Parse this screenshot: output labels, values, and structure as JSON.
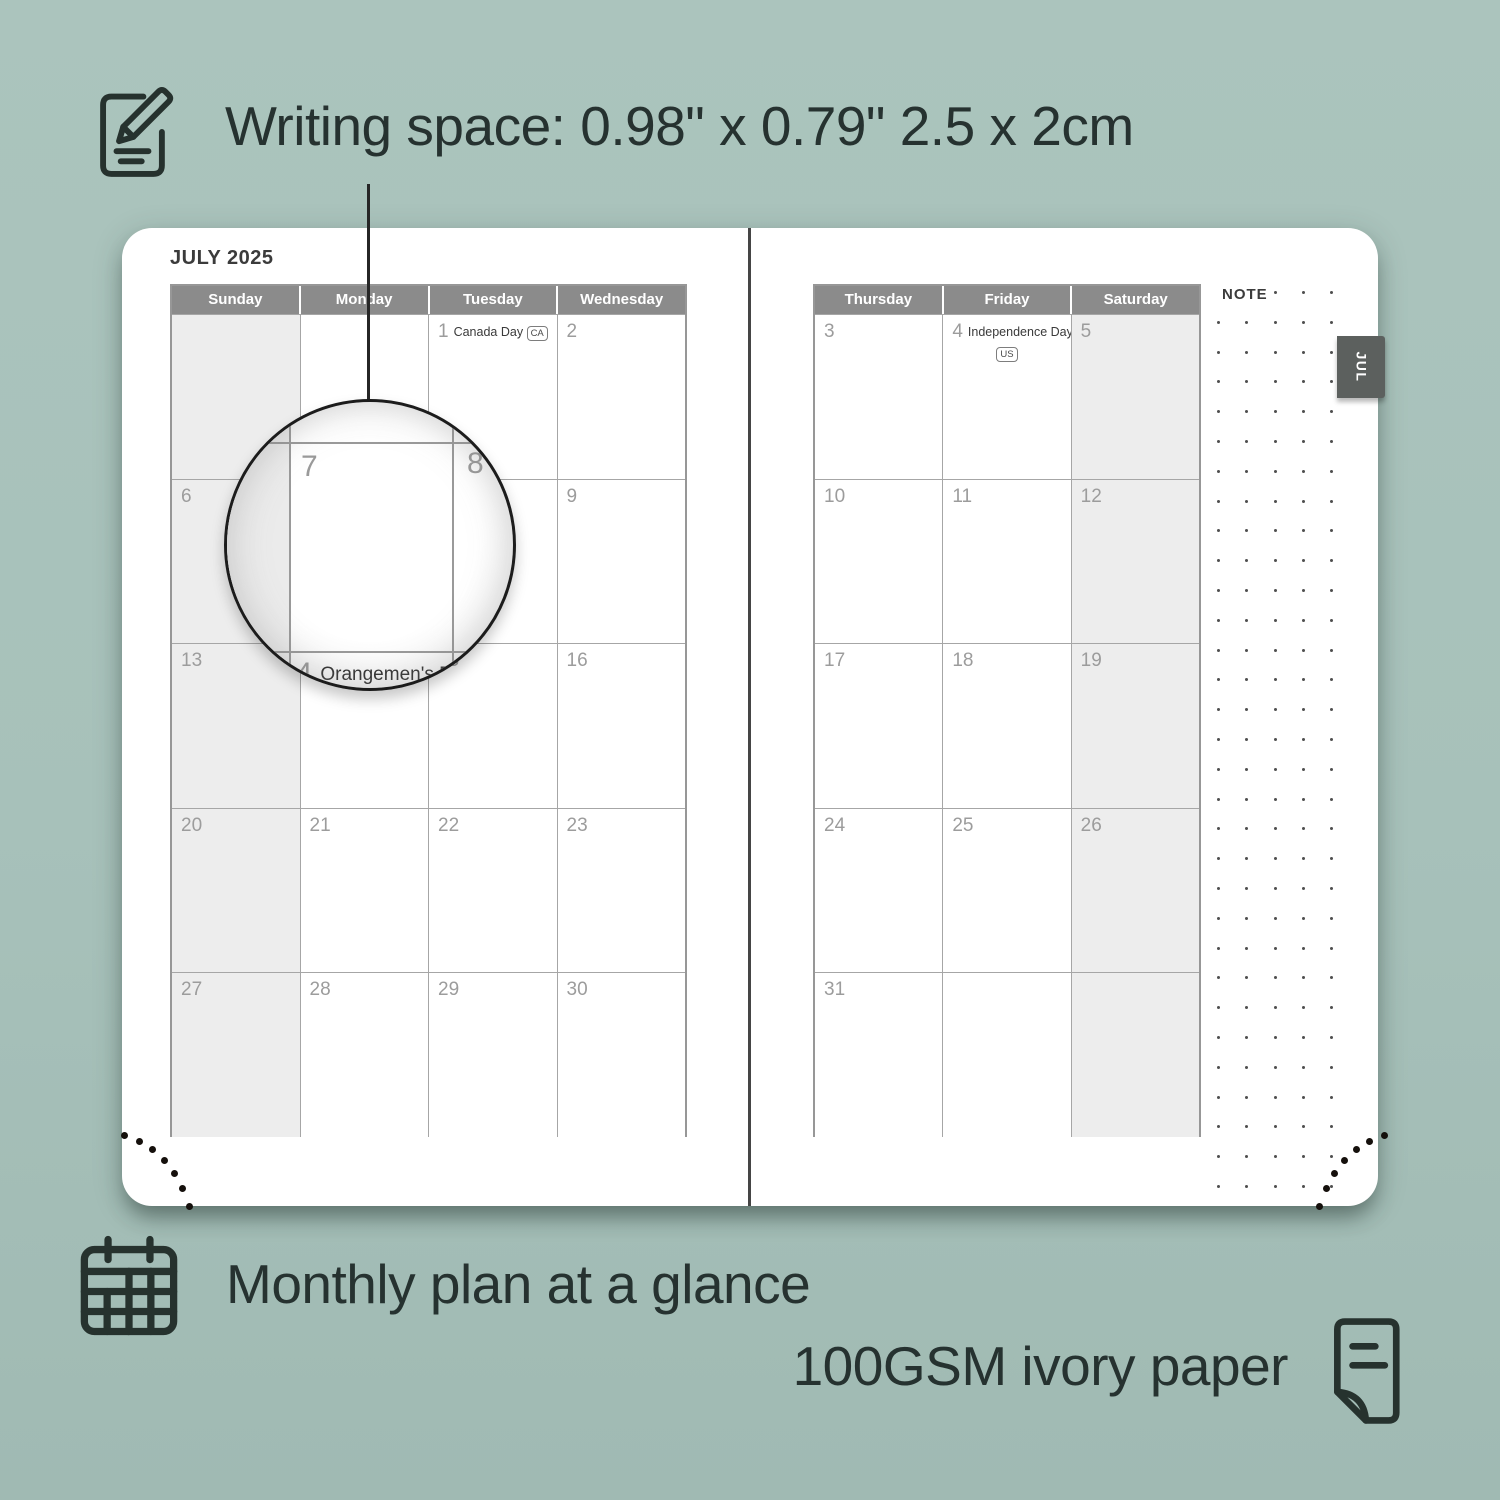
{
  "colors": {
    "background": "#a7c1ba",
    "card": "#ffffff",
    "header_gray": "#8b8b8b",
    "weekend_shade": "#ededed",
    "grid_line": "#a6a6a6",
    "day_number": "#9c9c9c",
    "dark_text": "#263230",
    "tab_gray": "#5c605e",
    "spine": "#454545"
  },
  "icons": {
    "top_left": "notepad-pencil-icon",
    "bottom_left": "calendar-grid-icon",
    "bottom_right": "paper-sheet-icon"
  },
  "captions": {
    "writing_space": "Writing space: 0.98\" x 0.79\" 2.5 x 2cm",
    "monthly": "Monthly plan at a glance",
    "paper": "100GSM ivory paper"
  },
  "planner": {
    "title": "JULY 2025",
    "note_label": "NOTE",
    "tab_label": "JUL",
    "left_headers": [
      "Sunday",
      "Monday",
      "Tuesday",
      "Wednesday"
    ],
    "right_headers": [
      "Thursday",
      "Friday",
      "Saturday"
    ],
    "left_weeks": [
      [
        {
          "day": ""
        },
        {
          "day": ""
        },
        {
          "day": "1",
          "holiday": "Canada Day",
          "badge": "CA",
          "badge_inline": true
        },
        {
          "day": "2"
        }
      ],
      [
        {
          "day": "6"
        },
        {
          "day": "7"
        },
        {
          "day": "8"
        },
        {
          "day": "9"
        }
      ],
      [
        {
          "day": "13"
        },
        {
          "day": "14",
          "holiday": "Orangemen's Day"
        },
        {
          "day": "15"
        },
        {
          "day": "16"
        }
      ],
      [
        {
          "day": "20"
        },
        {
          "day": "21"
        },
        {
          "day": "22"
        },
        {
          "day": "23"
        }
      ],
      [
        {
          "day": "27"
        },
        {
          "day": "28"
        },
        {
          "day": "29"
        },
        {
          "day": "30"
        }
      ]
    ],
    "right_weeks": [
      [
        {
          "day": "3"
        },
        {
          "day": "4",
          "holiday": "Independence Day",
          "badge": "US",
          "badge_inline": false
        },
        {
          "day": "5"
        }
      ],
      [
        {
          "day": "10"
        },
        {
          "day": "11"
        },
        {
          "day": "12"
        }
      ],
      [
        {
          "day": "17"
        },
        {
          "day": "18"
        },
        {
          "day": "19"
        }
      ],
      [
        {
          "day": "24"
        },
        {
          "day": "25"
        },
        {
          "day": "26"
        }
      ],
      [
        {
          "day": "31"
        },
        {
          "day": ""
        },
        {
          "day": ""
        }
      ]
    ]
  },
  "magnifier": {
    "day7_num": "7",
    "day8_num": "8",
    "day14_num": "14",
    "day14_holiday": "Orangemen's Day",
    "day14_subtext": "(NL)"
  }
}
